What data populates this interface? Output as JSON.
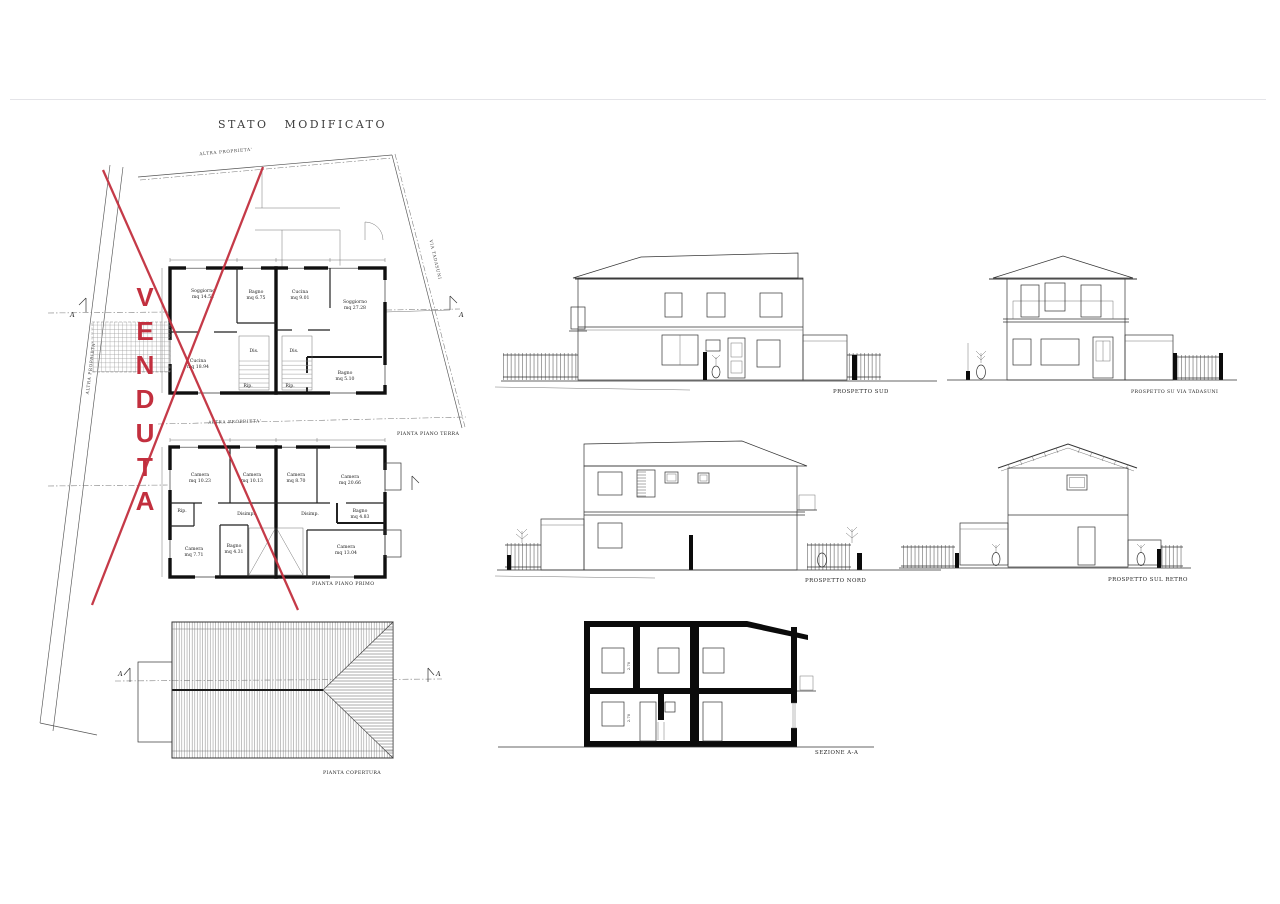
{
  "document": {
    "title": "STATO MODIFICATO"
  },
  "colors": {
    "venduta_red": "#c22f3e",
    "ink": "#1c1c1c",
    "faint_rule": "#e4e4e8"
  },
  "site_plan": {
    "venduta_overlay": "VENDUTA",
    "boundary_label_top": "ALTRA PROPRIETA'",
    "boundary_label_left": "ALTRA PROPRIETA'",
    "boundary_label_mid": "ALTRA PROPRIETA'",
    "road_label": "VIA TADASUNI",
    "section_marker_left": "A",
    "section_marker_right": "A"
  },
  "ground_floor_plan": {
    "caption": "PIANTA PIANO TERRA",
    "rooms": {
      "soggiorno_sx": {
        "name": "Soggiorno",
        "area": "mq 14.52"
      },
      "bagno_sx": {
        "name": "Bagno",
        "area": "mq 6.75"
      },
      "cucina_sx": {
        "name": "Cucina",
        "area": "mq 18.94"
      },
      "cucina_dx": {
        "name": "Cucina",
        "area": "mq 9.01"
      },
      "soggiorno_dx": {
        "name": "Soggiorno",
        "area": "mq 27.28"
      },
      "bagno_dx": {
        "name": "Bagno",
        "area": "mq 5.10"
      },
      "dis_sx": {
        "name": "Dis."
      },
      "dis_dx": {
        "name": "Dis."
      },
      "rip_sx": {
        "name": "Rip."
      },
      "rip_dx": {
        "name": "Rip."
      }
    }
  },
  "first_floor_plan": {
    "caption": "PIANTA PIANO PRIMO",
    "rooms": {
      "camera_1": {
        "name": "Camera",
        "area": "mq 10.23"
      },
      "camera_2": {
        "name": "Camera",
        "area": "mq 10.13"
      },
      "camera_3": {
        "name": "Camera",
        "area": "mq 8.70"
      },
      "camera_4": {
        "name": "Camera",
        "area": "mq 20.66"
      },
      "camera_5": {
        "name": "Camera",
        "area": "mq 7.71"
      },
      "camera_6": {
        "name": "Camera",
        "area": "mq 13.04"
      },
      "bagno_sx": {
        "name": "Bagno",
        "area": "mq 4.31"
      },
      "bagno_dx": {
        "name": "Bagno",
        "area": "mq 4.83"
      },
      "rip": {
        "name": "Rip."
      },
      "disimp_sx": {
        "name": "Disimp."
      },
      "disimp_dx": {
        "name": "Disimp."
      }
    }
  },
  "roof_plan": {
    "caption": "PIANTA COPERTURA",
    "section_marker_left": "A",
    "section_marker_right": "A"
  },
  "elevations": {
    "south": {
      "caption": "PROSPETTO SUD"
    },
    "street": {
      "caption": "PROSPETTO SU VIA TADASUNI"
    },
    "north": {
      "caption": "PROSPETTO NORD"
    },
    "rear": {
      "caption": "PROSPETTO SUL RETRO"
    }
  },
  "section": {
    "caption": "SEZIONE A-A",
    "height_upper": "2.70",
    "height_lower": "2.70"
  }
}
